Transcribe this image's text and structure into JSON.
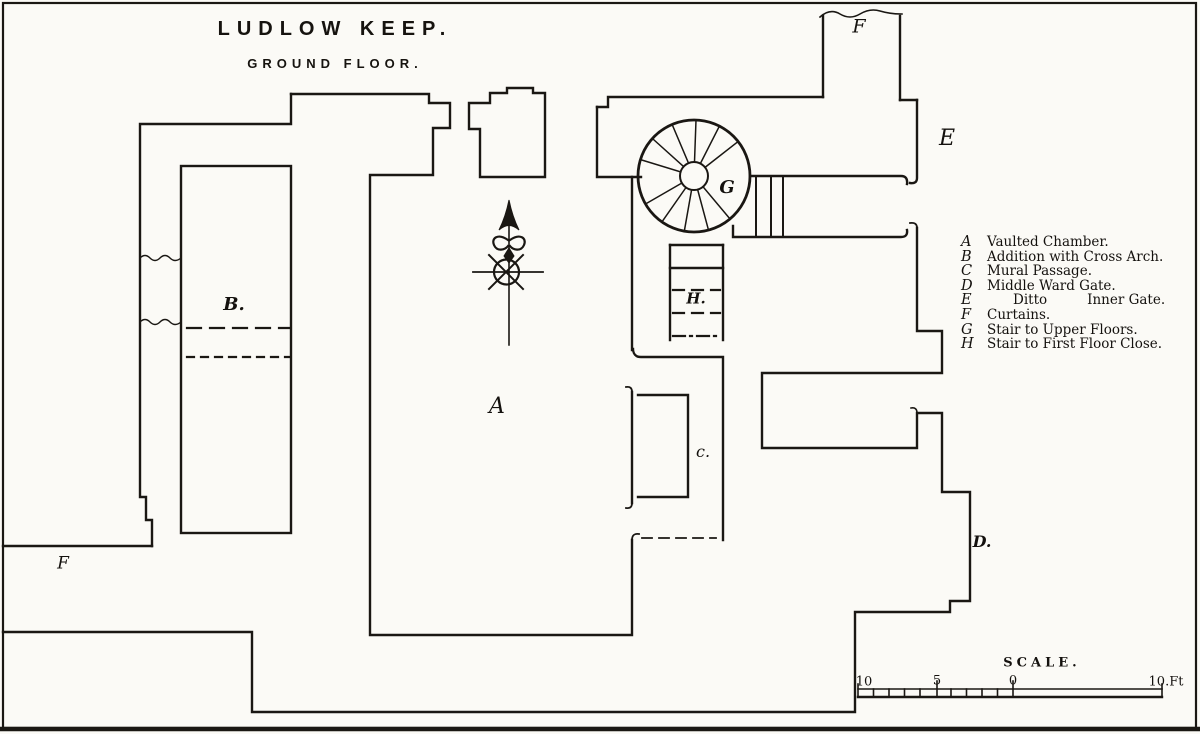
{
  "title": {
    "line1": "LUDLOW KEEP.",
    "line2": "GROUND FLOOR."
  },
  "legend": {
    "items": [
      {
        "key": "A",
        "desc": "Vaulted Chamber."
      },
      {
        "key": "B",
        "desc": "Addition with Cross Arch."
      },
      {
        "key": "C",
        "desc": "Mural Passage."
      },
      {
        "key": "D",
        "desc": "Middle Ward Gate."
      },
      {
        "key": "E",
        "desc": "Ditto",
        "desc2": "Inner Gate."
      },
      {
        "key": "F",
        "desc": "Curtains."
      },
      {
        "key": "G",
        "desc": "Stair to Upper Floors."
      },
      {
        "key": "H",
        "desc": "Stair to First Floor Close."
      }
    ]
  },
  "plan_labels": {
    "vaulted_chamber": "A",
    "addition": "B.",
    "mural_passage": "c.",
    "middle_ward_gate": "D.",
    "inner_gate": "E",
    "curtain_top": "F",
    "curtain_left": "F",
    "stair_upper": "G",
    "stair_first_floor": "H."
  },
  "scale": {
    "label": "SCALE.",
    "tick_left": "10",
    "tick_mid": "5",
    "tick_zero": "0",
    "tick_right": "10.Ft"
  },
  "colors": {
    "ink": "#1a1713",
    "paper": "#fbfaf6"
  }
}
